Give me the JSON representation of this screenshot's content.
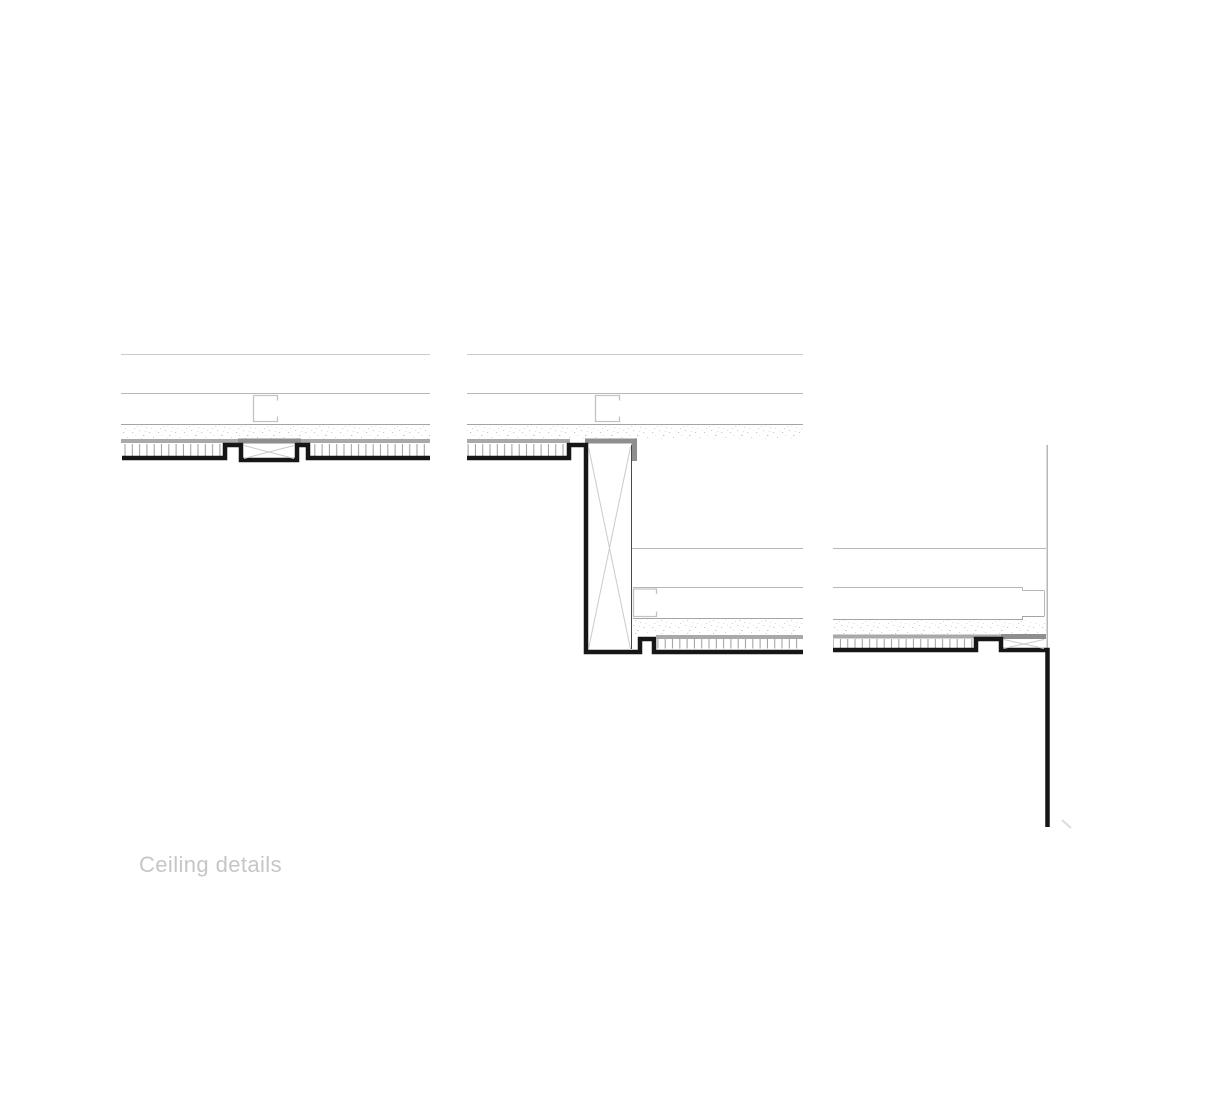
{
  "title": {
    "label": "Ceiling details"
  },
  "colors": {
    "ink": "#161616",
    "line_faint": "#cccccc",
    "line_light": "#b7b7b7",
    "line_mid": "#a5a5a5",
    "profile": "#c3c3c3",
    "band": "#a9a9a9",
    "band_dark": "#8e8e8e",
    "x_brace": "#cacaca",
    "beam_edge": "#4a4a4a",
    "hatch": "#9c9c9c",
    "stipple": "#b9b9b9",
    "tick": "#dcdcdc",
    "title_text": "#c6c6c6",
    "background": "#ffffff"
  }
}
